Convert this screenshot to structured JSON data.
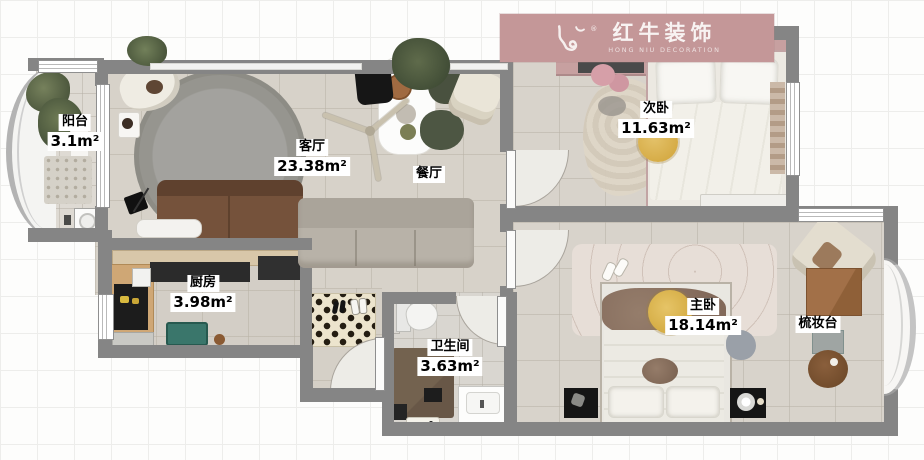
{
  "brand_banner": {
    "name_cn": "红牛装饰",
    "name_en": "HONG NIU DECORATION",
    "registered_mark": "®"
  },
  "rooms": [
    {
      "key": "balcony",
      "name": "阳台",
      "area": "3.1m²"
    },
    {
      "key": "living",
      "name": "客厅",
      "area": "23.38m²"
    },
    {
      "key": "dining",
      "name": "餐厅",
      "area": ""
    },
    {
      "key": "bedroom2",
      "name": "次卧",
      "area": "11.63m²"
    },
    {
      "key": "kitchen",
      "name": "厨房",
      "area": "3.98m²"
    },
    {
      "key": "bathroom",
      "name": "卫生间",
      "area": "3.63m²"
    },
    {
      "key": "master",
      "name": "主卧",
      "area": "18.14m²"
    },
    {
      "key": "vanity",
      "name": "梳妆台",
      "area": ""
    }
  ],
  "colors": {
    "banner_pink": "#c49798",
    "wall_gray": "#858585",
    "floor_tile": "#d7d2c9",
    "wardrobe_pink": "#c7a0a0",
    "accent_yellow": "#ddb757",
    "sofa_brown": "#75523b",
    "sofa_gray": "#b8b2a8",
    "kitchen_cart_teal": "#3a766b"
  },
  "icons": [
    "bull-logo-icon"
  ]
}
